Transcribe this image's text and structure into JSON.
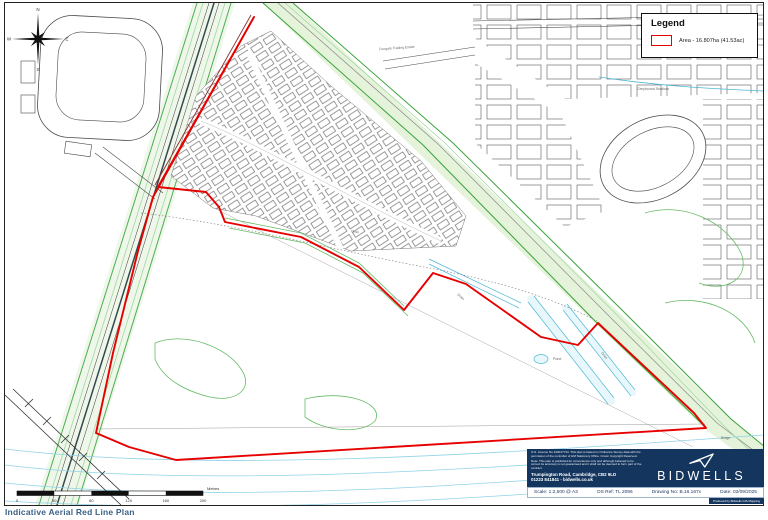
{
  "page": {
    "title": "Indicative Aerial Red Line Plan"
  },
  "legend": {
    "title": "Legend",
    "area_label": "Area - 16.807ha (41.53ac)"
  },
  "compass": {
    "n": "N",
    "e": "E",
    "s": "S",
    "w": "W"
  },
  "map_labels": {
    "stadium": "Greyhound Stadium",
    "trading_estate": "Fengate Trading Estate",
    "pond": "Pond",
    "drain": "Drain",
    "bridge": "Bridge"
  },
  "scalebar": {
    "unit": "Metres",
    "ticks": [
      "0",
      "40",
      "80",
      "120",
      "160",
      "200"
    ]
  },
  "info_box": {
    "license_1": "O.S. Licence No 100017734. This plan is based on Ordnance Survey data with the permission of the controller of HM Stationery Office. Crown Copyright Reserved.",
    "license_2": "Note: This plan is published for convenience only and although believed to be correct its accuracy is not guaranteed and it shall not be deemed to form part of the contract.",
    "address": "Trumpington Road, Cambridge, CB2 9LD",
    "contact": "01223 841841  -  bidwells.co.uk",
    "brand": "BIDWELLS",
    "produced_by": "Produced by Bidwells GIS Mapping"
  },
  "footer": {
    "scale": "Scale:  1:2,500  @ A3",
    "os_ref": "OS Ref:  TL 2096",
    "drawing_no": "Drawing No:  B.16.167x",
    "date": "Date:  02/09/2025"
  },
  "colors": {
    "boundary_red": "#e60000",
    "brand_navy": "#14355e",
    "map_green": "#3aa23a",
    "water_cyan": "#54bcd9",
    "title_blue": "#3a6186"
  }
}
